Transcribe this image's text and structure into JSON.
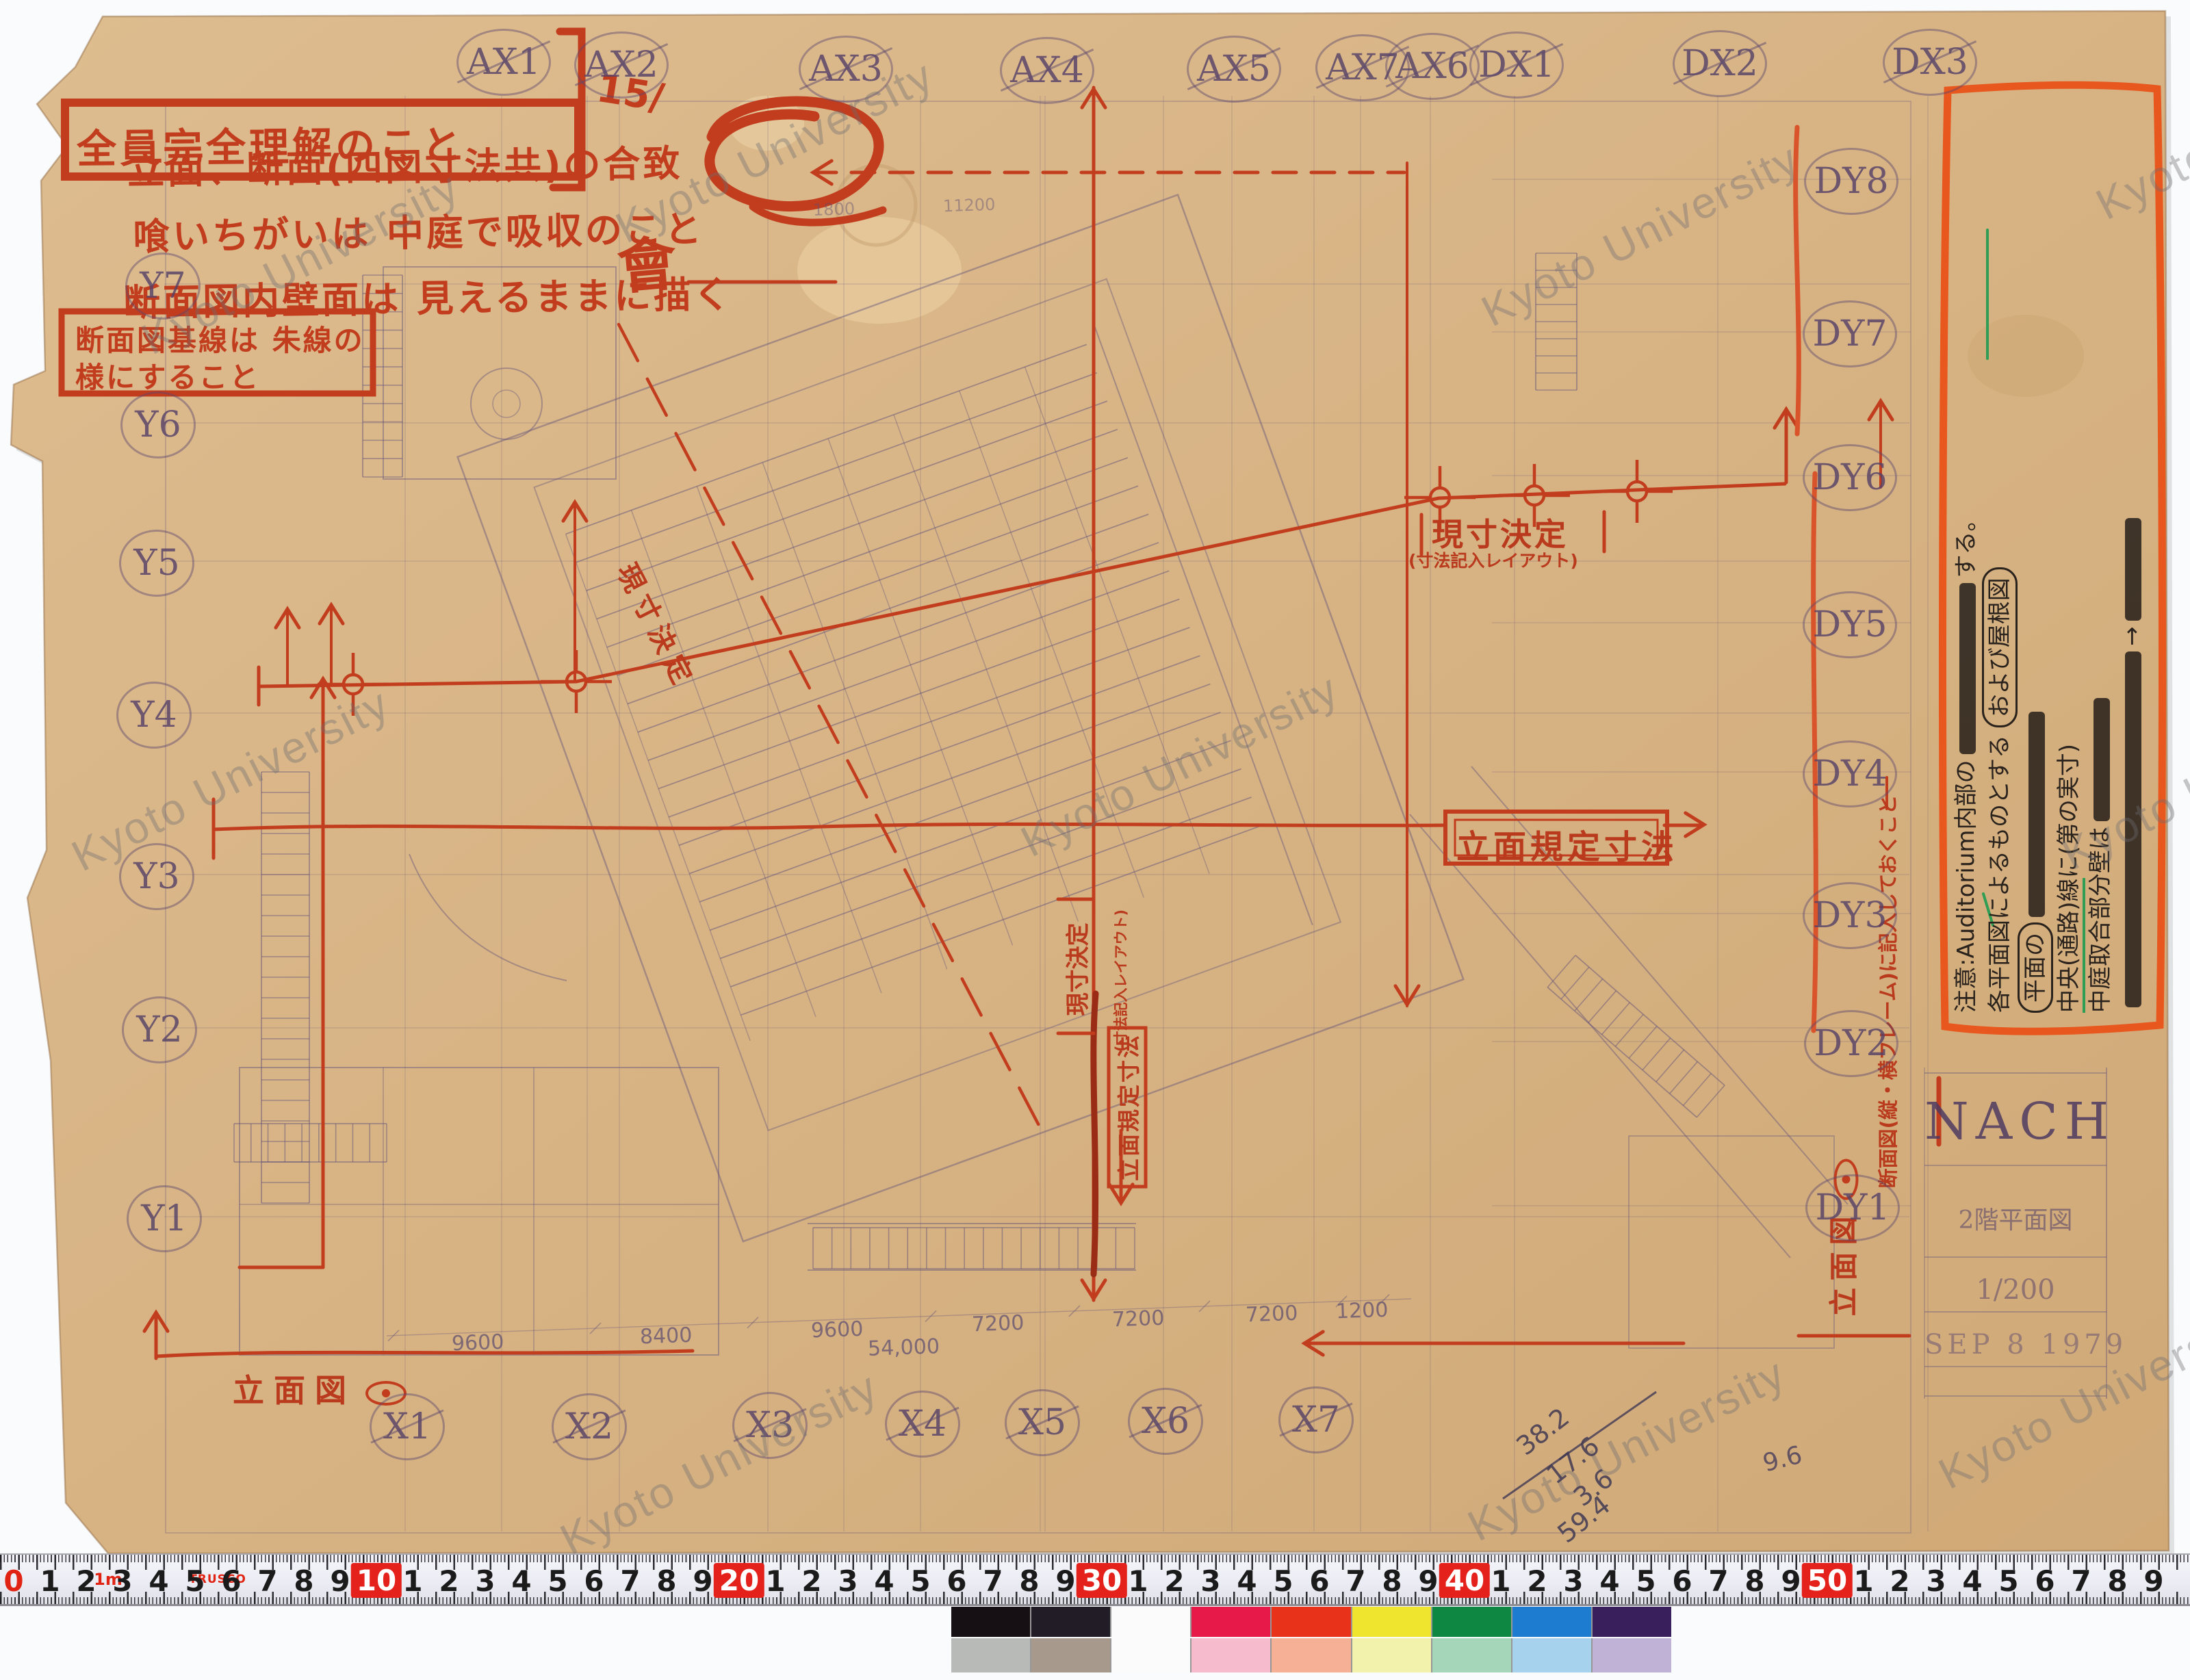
{
  "watermark_text": "Kyoto University",
  "header_notes": {
    "boxed_note": "全員完全理解のこと",
    "date_mark": "15/",
    "kai_mark": "會",
    "line1": "立面、断面(四図寸法共)の合致",
    "line2": "喰いちがいは 中庭で吸収のこと",
    "line3": "断面図内壁面は 見えるままに描く",
    "boxed_note2_line1": "断面図基線は 朱線の",
    "boxed_note2_line2": "様にすること"
  },
  "grid_labels": {
    "top": [
      "AX1",
      "AX2",
      "AX3",
      "AX4",
      "AX5",
      "AX6",
      "AX7",
      "DX1",
      "DX2",
      "DX3"
    ],
    "right": [
      "DY8",
      "DY7",
      "DY6",
      "DY5",
      "DY4",
      "DY3",
      "DY2",
      "DY1"
    ],
    "left": [
      "Y7",
      "Y6",
      "Y5",
      "Y4",
      "Y3",
      "Y2",
      "Y1"
    ],
    "bottom": [
      "X1",
      "X2",
      "X3",
      "X4",
      "X5",
      "X6",
      "X7"
    ]
  },
  "red_stamps": {
    "elevation_rule_h": "立面規定寸法",
    "elevation_rule_v": "立面規定寸法",
    "genzun_h": "現寸決定",
    "genzun_h_sub": "(寸法記入レイアウト)",
    "genzun_v": "現寸決定",
    "genzun_v_sub": "(寸法記入レイアウト)",
    "genzun_diag": "現寸決定",
    "elevation_view_left": "立面図",
    "elevation_view_right": "立面図",
    "section_frame_note": "断面図(縦・横フレーム)に記入しておくこと"
  },
  "margin_note": {
    "l1": "中庭取合部分壁は",
    "l2a": "中央(通路)線",
    "l2b": "に(第の実寸)",
    "l3": "注意:Auditorium内部の",
    "l3b": "する。",
    "l4": "各平面図によるものとする",
    "circled_a": "平面の",
    "circled_b": "および屋根図",
    "arrow": "→"
  },
  "title_block": {
    "stamp": "NACH",
    "title": "2階平面図",
    "scale": "1/200",
    "date": "SEP 8 1979"
  },
  "pencil_dimensions": {
    "values": [
      "9600",
      "8400",
      "9600",
      "7200",
      "7200",
      "7200",
      "1200"
    ],
    "total": "54,000",
    "upper_a": "1800",
    "upper_b": "11200"
  },
  "pencil_calc": {
    "values": [
      "38.2",
      "17.6",
      "3.6",
      "59.4"
    ],
    "extra": "9.6"
  },
  "ruler": {
    "zero": "0",
    "tens": [
      "10",
      "20",
      "30",
      "40",
      "50"
    ],
    "meter_mark": "1m",
    "brand": "TRUSCO"
  },
  "color_bar": {
    "top_row": [
      "#161014",
      "#221c26",
      "#fbfbfb",
      "#e61948",
      "#e8321a",
      "#efe52e",
      "#0e8742",
      "#1e7cd0",
      "#3a1f5d"
    ],
    "bottom_row": [
      "#b7bab6",
      "#a79a8d",
      "#fbfbfb",
      "#f6bccd",
      "#f6b096",
      "#f2f2ac",
      "#a5d6b9",
      "#a6d2ee",
      "#bfb2d6"
    ]
  }
}
